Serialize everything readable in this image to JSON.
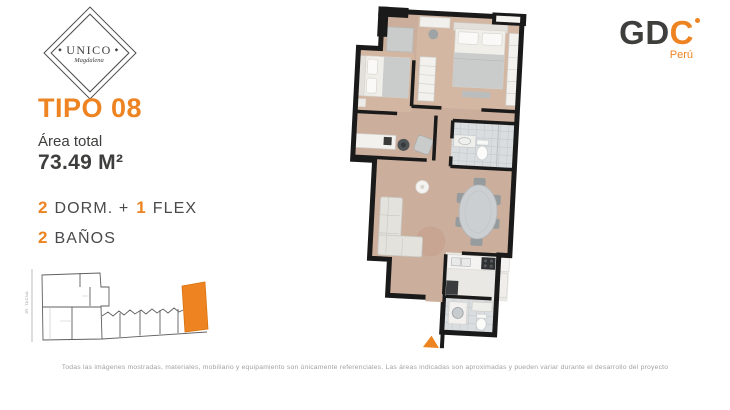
{
  "brand": {
    "logo_title": "UNICO",
    "logo_subtitle": "Magdalena",
    "ornament": "◆"
  },
  "developer": {
    "name_prefix": "GD",
    "name_accent": "C",
    "country": "Perú"
  },
  "unit": {
    "type": "TIPO 08",
    "area_label": "Área total",
    "area_value": "73.49 M²",
    "specs": {
      "dorm_num": "2",
      "dorm_text": "DORM. +",
      "flex_num": "1",
      "flex_text": "FLEX",
      "bath_num": "2",
      "bath_text": "BAÑOS"
    }
  },
  "minimap": {
    "street": "JR. TACNA"
  },
  "footer": {
    "disclaimer": "Todas las imágenes mostradas, materiales, mobiliario y equipamiento son únicamente referenciales. Las áreas indicadas son aproximadas y pueden variar durante el desarrollo del proyecto"
  },
  "colors": {
    "accent": "#EE8322",
    "dark": "#3E3E3D",
    "muted": "#A2A2A2",
    "wall": "#1A1A1A",
    "wood": "#CBAE9B",
    "tile": "#D9DDDF"
  }
}
